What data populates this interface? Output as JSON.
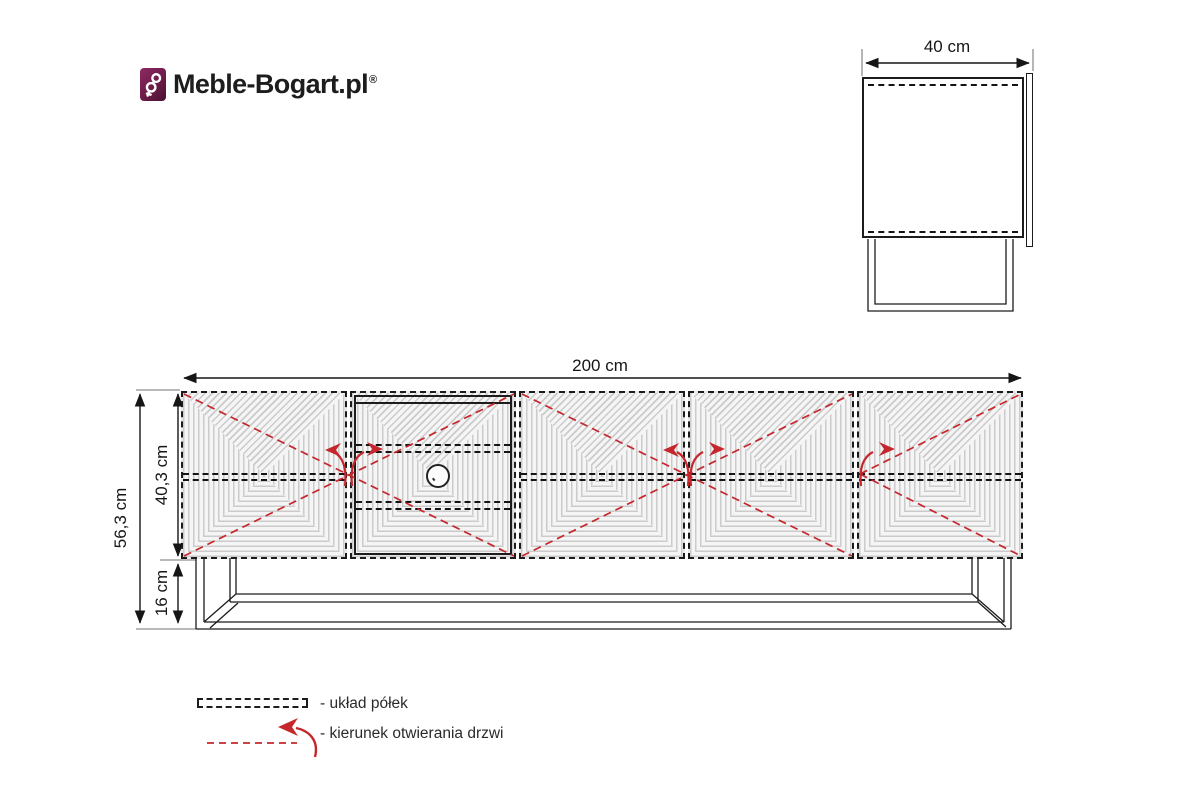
{
  "brand": {
    "name": "Meble-Bogart.pl",
    "registered_mark": "®",
    "icon": "key-icon"
  },
  "views": {
    "side": {
      "width_label": "40 cm"
    },
    "front": {
      "width_label": "200 cm",
      "total_height_label": "56,3 cm",
      "carcass_height_label": "40,3 cm",
      "legs_height_label": "16 cm"
    }
  },
  "legend": {
    "items": [
      {
        "id": "shelf-layout",
        "symbol": "dashed-line-symbol",
        "label": "- układ półek"
      },
      {
        "id": "door-opening",
        "symbol": "red-arrow-symbol",
        "label": "- kierunek otwierania drzwi"
      }
    ]
  },
  "colors": {
    "accent_red": "#c5272d",
    "line": "#1c1c1c",
    "panel_fill": "#e9e9e9",
    "logo_purple": "#6d1c49"
  }
}
